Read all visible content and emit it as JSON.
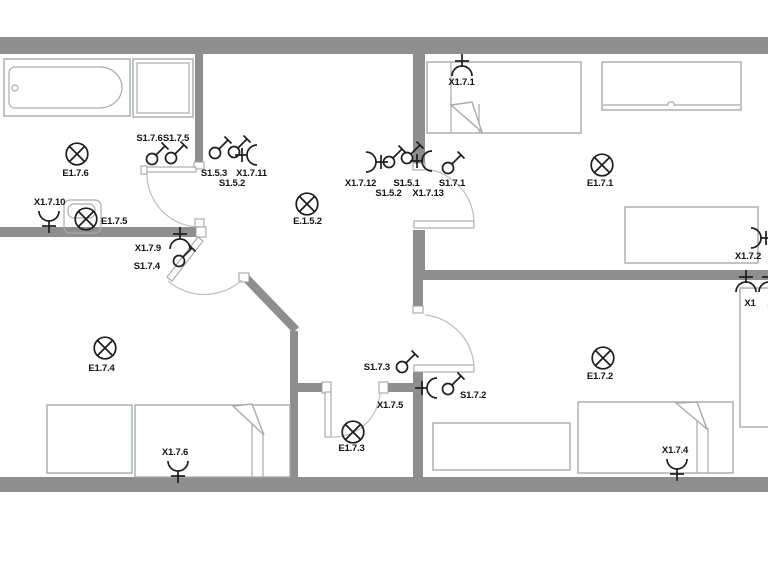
{
  "plan_type": "electrical-floor-plan",
  "colors": {
    "wall": "#8e8e8e",
    "symbol": "#1d1d1d",
    "furniture_outline": "#a6abad",
    "door_swing": "#bdbdbd",
    "label": "#141414",
    "background": "#ffffff"
  },
  "symbol_kinds": {
    "light": "circle-with-x",
    "switch": "circle-with-diagonal-toggle",
    "socket": "semicircle-with-stem"
  },
  "furniture": [
    "bathtub",
    "shower",
    "bed",
    "wardrobe",
    "desk",
    "washer-light-box"
  ],
  "lights": [
    {
      "label": "E1.7.6"
    },
    {
      "label": "E1.7.5"
    },
    {
      "label": "E.1.5.2"
    },
    {
      "label": "E1.7.1"
    },
    {
      "label": "E1.7.2"
    },
    {
      "label": "E1.7.3"
    },
    {
      "label": "E1.7.4"
    }
  ],
  "switches": [
    {
      "label": "S1.7.6"
    },
    {
      "label": "S1.7.5"
    },
    {
      "label": "S1.5.3"
    },
    {
      "label": "S1.5.2"
    },
    {
      "label": "S1.5.1"
    },
    {
      "label": "S1.5.2"
    },
    {
      "label": "S1.7.1"
    },
    {
      "label": "S1.7.4"
    },
    {
      "label": "S1.7.3"
    },
    {
      "label": "S1.7.2"
    }
  ],
  "sockets": [
    {
      "label": "X1.7.10"
    },
    {
      "label": "X1.7.11"
    },
    {
      "label": "X1.7.9"
    },
    {
      "label": "X1.7.12"
    },
    {
      "label": "X1.7.13"
    },
    {
      "label": "X1.7.1"
    },
    {
      "label": "X1.7.2"
    },
    {
      "label": "X1.7.5"
    },
    {
      "label": "X1.7.6"
    },
    {
      "label": "X1.7.4"
    },
    {
      "label": "X1"
    },
    {
      "label": "X1"
    }
  ]
}
